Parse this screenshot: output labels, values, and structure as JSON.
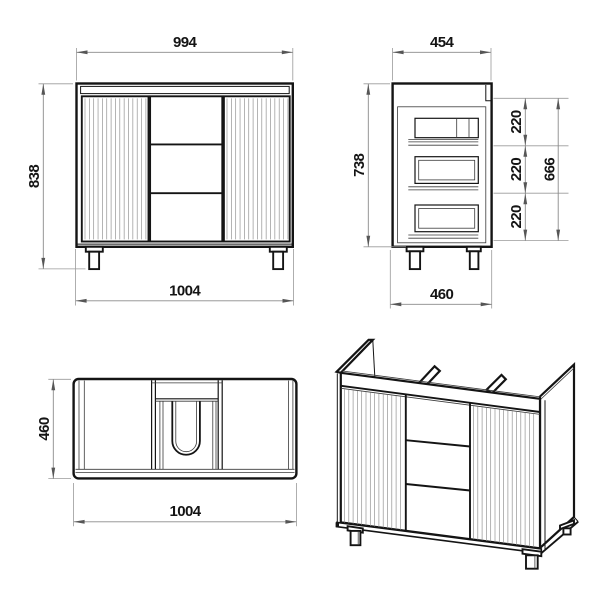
{
  "drawing": {
    "type": "technical-drawing",
    "subject": "bathroom vanity cabinet with two fluted doors, three central drawers and legs",
    "units": "mm",
    "colors": {
      "background": "#ffffff",
      "object_line": "#141414",
      "dimension_line": "#8a8a8a",
      "arrow": "#565656",
      "text": "#141414"
    },
    "views": {
      "front": {
        "label": "front view",
        "dimensions": {
          "top_width": "994",
          "height": "838",
          "bottom_width": "1004"
        }
      },
      "side": {
        "label": "side view",
        "dimensions": {
          "top_depth": "454",
          "height": "738",
          "drawer_pitch_top": "220",
          "drawer_pitch_middle": "220",
          "drawer_pitch_bottom": "220",
          "drawer_stack_height": "666",
          "bottom_depth": "460"
        }
      },
      "top": {
        "label": "top view",
        "dimensions": {
          "depth": "460",
          "width": "1004"
        }
      },
      "perspective": {
        "label": "isometric view"
      }
    }
  }
}
